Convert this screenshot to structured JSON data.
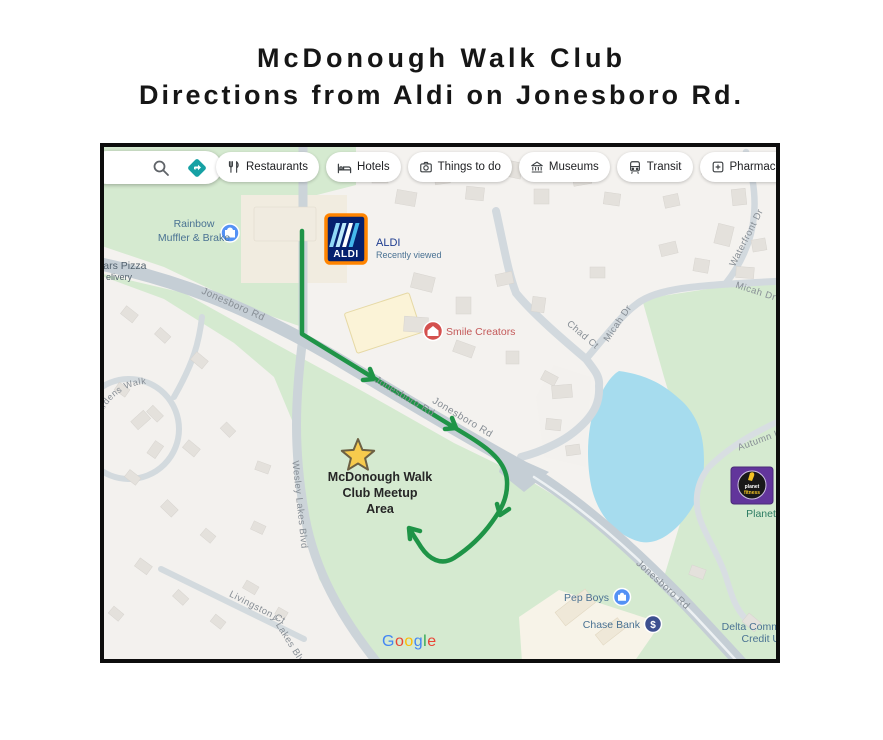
{
  "page": {
    "title_line1": "McDonough Walk Club",
    "title_line2": "Directions from Aldi on Jonesboro Rd."
  },
  "toolbar": {
    "search_icons": [
      "search-icon",
      "directions-icon"
    ],
    "chips": [
      {
        "label": "Restaurants",
        "icon": "restaurants-icon"
      },
      {
        "label": "Hotels",
        "icon": "hotels-icon"
      },
      {
        "label": "Things to do",
        "icon": "things-to-do-icon"
      },
      {
        "label": "Museums",
        "icon": "museums-icon"
      },
      {
        "label": "Transit",
        "icon": "transit-icon"
      },
      {
        "label": "Pharmacies",
        "icon": "pharmacies-icon"
      },
      {
        "label": "ATMs",
        "icon": "atm-icon",
        "icon_text": "ATM"
      }
    ]
  },
  "map": {
    "poi": {
      "rainbow_line1": "Rainbow",
      "rainbow_line2": "Muffler & Brake",
      "caesars_line1": "sars Pizza",
      "caesars_line2": "elivery",
      "aldi_name": "ALDI",
      "aldi_status": "Recently viewed",
      "aldi_logo_text": "ALDI",
      "smile": "Smile Creators",
      "pep_boys": "Pep Boys",
      "chase_bank": "Chase Bank",
      "chase_symbol": "$",
      "delta_line1": "Delta Comm",
      "delta_line2": "Credit U",
      "planet_label": "Planet",
      "pf_logo_line1": "planet",
      "pf_logo_line2": "fitness"
    },
    "roads": {
      "jonesboro": "Jonesboro Rd",
      "wesley": "Wesley Lakes Blvd",
      "wesley_partial": "y Lakes Blvd",
      "livingston": "Livingston Ct",
      "chad": "Chad Ct",
      "micah": "Micah Dr",
      "waterfront": "Waterfront Dr",
      "autumn": "Autumn L",
      "magnolia": "Magnolia Gardens Walk"
    },
    "annotation": {
      "meetup_line1": "McDonough Walk",
      "meetup_line2": "Club Meetup",
      "meetup_line3": "Area"
    },
    "watermark_letters": [
      {
        "ch": "G",
        "color": "#4285F4"
      },
      {
        "ch": "o",
        "color": "#EA4335"
      },
      {
        "ch": "o",
        "color": "#FBBC05"
      },
      {
        "ch": "g",
        "color": "#4285F4"
      },
      {
        "ch": "l",
        "color": "#34A853"
      },
      {
        "ch": "e",
        "color": "#EA4335"
      }
    ],
    "colors": {
      "route": "#1f9447",
      "water": "#a6dcee",
      "green": "#d5ead0",
      "road": "#c5ced5",
      "star_fill": "#f7cb4d",
      "star_stroke": "#6d6143",
      "aldi_navy": "#05206e",
      "aldi_orange": "#ff8400",
      "pf_purple": "#62359b",
      "poi_blue": "#5491f5",
      "chase_navy": "#3d4f8f",
      "smile_red": "#d4504e",
      "label_blue": "#4a7293",
      "label_red": "#c45959",
      "label_green": "#2e7d64",
      "road_label": "#878e95"
    }
  }
}
